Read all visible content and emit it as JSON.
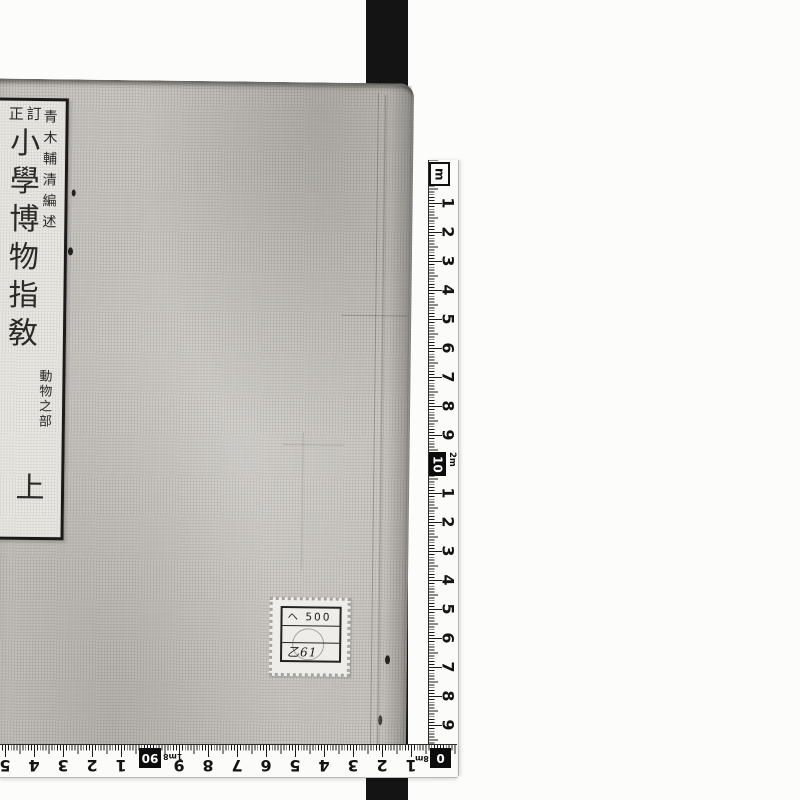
{
  "photo": {
    "subject": "book-cover",
    "background_color": "#fcfcfb",
    "strap_color": "#141414",
    "cover_color": "#c9c6c1"
  },
  "label": {
    "revision": "訂正",
    "title": "小學博物指敎",
    "author": "青木輔清編述",
    "section": "動物之部",
    "volume": "上"
  },
  "sticker": {
    "line1": "ヘ 500",
    "line2": "",
    "line3": "乙61"
  },
  "vertical_ruler": {
    "unit_box": "m",
    "upper_numbers": [
      "1",
      "2",
      "3",
      "4",
      "5",
      "6",
      "7",
      "8",
      "9"
    ],
    "mid_box": "10",
    "mid_annotation": "2m",
    "lower_numbers": [
      "1",
      "2",
      "3",
      "4",
      "5",
      "6",
      "7",
      "8",
      "9"
    ]
  },
  "horizontal_ruler": {
    "left_partial": "5",
    "left_numbers": [
      "4",
      "3",
      "2",
      "1"
    ],
    "mid_box": "90",
    "mid_annotation": "1m8",
    "right_numbers": [
      "9",
      "8",
      "7",
      "6",
      "5",
      "4",
      "3",
      "2",
      "1"
    ],
    "end_box": "0",
    "end_annotation": "8m"
  }
}
